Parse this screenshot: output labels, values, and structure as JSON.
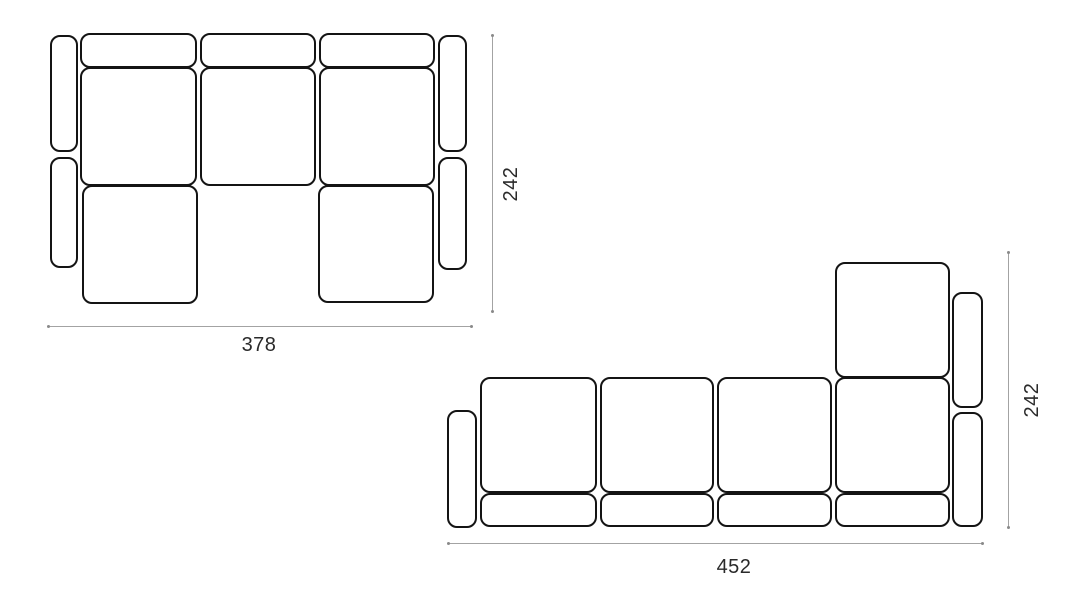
{
  "canvas": {
    "width": 1067,
    "height": 600,
    "background": "#ffffff"
  },
  "style": {
    "piece_fill": "#ffffff",
    "piece_outline_color": "#141414",
    "piece_outline_width_px": 2.5,
    "piece_corner_radius_px": 10,
    "dimension_line_color": "#a3a3a3",
    "label_color": "#2a2a2a",
    "label_font_size_px": 20
  },
  "diagrams": [
    {
      "id": "sofa-top-view-u-shape",
      "shape": "u-shaped-sectional-sofa-top-view",
      "width_dimension": {
        "label": "378",
        "x1": 48,
        "x2": 472,
        "y": 326,
        "label_x": 259,
        "label_y": 334
      },
      "height_dimension": {
        "label": "242",
        "x": 492,
        "y1": 35,
        "y2": 312,
        "label_cx": 511,
        "label_cy": 184
      },
      "pieces": [
        {
          "name": "armrest-left-upper",
          "x": 50,
          "y": 35,
          "w": 28,
          "h": 117
        },
        {
          "name": "armrest-left-lower",
          "x": 50,
          "y": 157,
          "w": 28,
          "h": 111
        },
        {
          "name": "backrest-cushion-1",
          "x": 80,
          "y": 33,
          "w": 117,
          "h": 35
        },
        {
          "name": "backrest-cushion-2",
          "x": 200,
          "y": 33,
          "w": 116,
          "h": 35
        },
        {
          "name": "backrest-cushion-3",
          "x": 319,
          "y": 33,
          "w": 116,
          "h": 35
        },
        {
          "name": "seat-cushion-1",
          "x": 80,
          "y": 67,
          "w": 117,
          "h": 119
        },
        {
          "name": "seat-cushion-2",
          "x": 200,
          "y": 67,
          "w": 116,
          "h": 119
        },
        {
          "name": "seat-cushion-3",
          "x": 319,
          "y": 67,
          "w": 116,
          "h": 119
        },
        {
          "name": "chaise-seat-left",
          "x": 82,
          "y": 185,
          "w": 116,
          "h": 119
        },
        {
          "name": "chaise-seat-right",
          "x": 318,
          "y": 185,
          "w": 116,
          "h": 118
        },
        {
          "name": "armrest-right-upper",
          "x": 438,
          "y": 35,
          "w": 29,
          "h": 117
        },
        {
          "name": "armrest-right-lower",
          "x": 438,
          "y": 157,
          "w": 29,
          "h": 113
        }
      ]
    },
    {
      "id": "sofa-top-view-right-chaise",
      "shape": "sectional-sofa-with-right-chaise-top-view",
      "width_dimension": {
        "label": "452",
        "x1": 448,
        "x2": 983,
        "y": 543,
        "label_x": 734,
        "label_y": 556
      },
      "height_dimension": {
        "label": "242",
        "x": 1008,
        "y1": 252,
        "y2": 528,
        "label_cx": 1032,
        "label_cy": 400
      },
      "pieces": [
        {
          "name": "armrest-left",
          "x": 447,
          "y": 410,
          "w": 30,
          "h": 118
        },
        {
          "name": "chaise-seat",
          "x": 835,
          "y": 262,
          "w": 115,
          "h": 116
        },
        {
          "name": "seat-cushion-1",
          "x": 480,
          "y": 377,
          "w": 117,
          "h": 116
        },
        {
          "name": "seat-cushion-2",
          "x": 600,
          "y": 377,
          "w": 114,
          "h": 116
        },
        {
          "name": "seat-cushion-3",
          "x": 717,
          "y": 377,
          "w": 115,
          "h": 116
        },
        {
          "name": "seat-cushion-4",
          "x": 835,
          "y": 377,
          "w": 115,
          "h": 116
        },
        {
          "name": "front-cushion-1",
          "x": 480,
          "y": 493,
          "w": 117,
          "h": 34
        },
        {
          "name": "front-cushion-2",
          "x": 600,
          "y": 493,
          "w": 114,
          "h": 34
        },
        {
          "name": "front-cushion-3",
          "x": 717,
          "y": 493,
          "w": 115,
          "h": 34
        },
        {
          "name": "front-cushion-4",
          "x": 835,
          "y": 493,
          "w": 115,
          "h": 34
        },
        {
          "name": "armrest-right-upper",
          "x": 952,
          "y": 292,
          "w": 31,
          "h": 116
        },
        {
          "name": "armrest-right-lower",
          "x": 952,
          "y": 412,
          "w": 31,
          "h": 115
        }
      ]
    }
  ]
}
